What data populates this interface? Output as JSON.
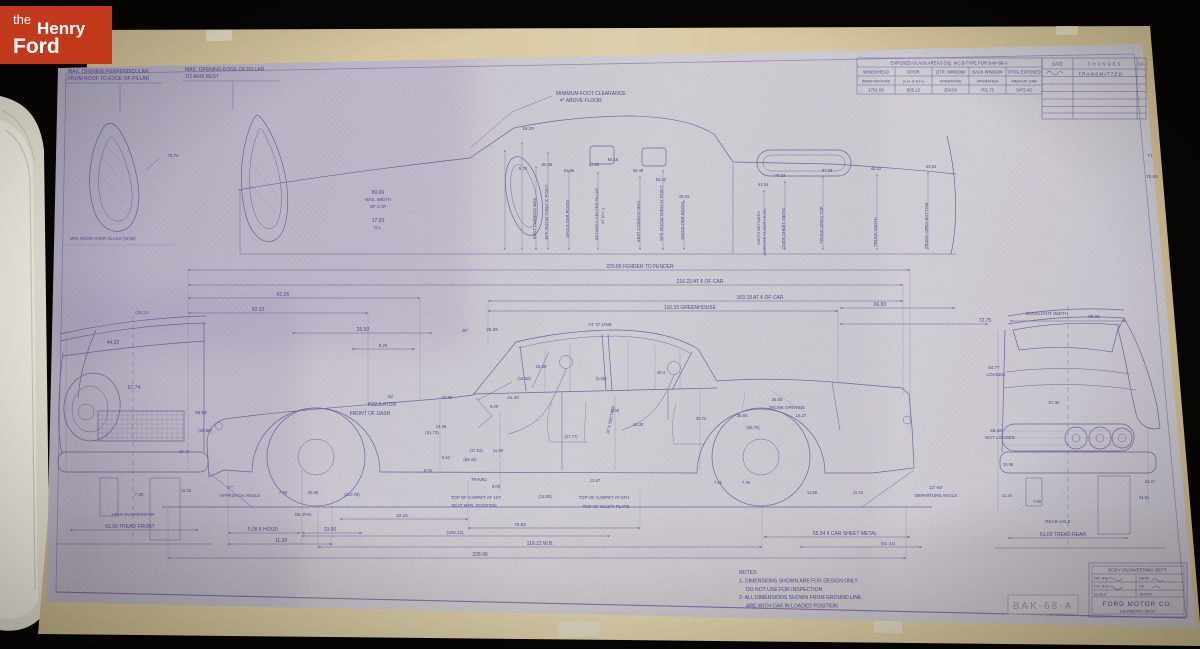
{
  "logo": {
    "prefix": "the",
    "name_top": "Henry",
    "name_bottom": "Ford"
  },
  "stamp": {
    "text": "BAK-68-A"
  },
  "colors": {
    "logo_red": "#c2391b",
    "paper": "#c8c3cd",
    "backing": "#d3c5a0",
    "ink": "#4f4890",
    "stamp_gray": "#8f8b9b"
  },
  "glass_table": {
    "title": "EXPOSED GLASS AREAS (SQ. IN.) B TYPE FOR BAK-68-A",
    "columns": [
      "WINDSHIELD",
      "DOOR",
      "QTR. WINDOW",
      "BACK WINDOW",
      "TOTAL EXPOSED"
    ],
    "sub_labels": [
      "WRAP AROUND",
      "(L.H. & R.H.)",
      "OPERATING",
      "OPERATING",
      "AREA OF CAR"
    ],
    "values": [
      "1701.03",
      "905.12",
      "254.50",
      "701.72",
      "3472.43"
    ]
  },
  "changes_table": {
    "columns": [
      "DATE",
      "CHANGES",
      "CK."
    ],
    "rows": [
      {
        "date": "",
        "change": "TRANSMITTED",
        "ck": ""
      }
    ]
  },
  "title_block": {
    "department": "BODY ENGINEERING DEPT.",
    "fields": [
      [
        "DR. BY",
        "DATE"
      ],
      [
        "CH. BY",
        "CK."
      ],
      [
        "SCALE",
        "TENTH"
      ]
    ],
    "company": "FORD MOTOR CO.",
    "location": "DEARBORN, MICH."
  },
  "notes": {
    "lines": [
      "NOTES:",
      "1- DIMENSIONS SHOWN ARE FOR DESIGN ONLY",
      "DO NOT USE FOR INSPECTION",
      "2- ALL DIMENSIONS SHOWN FROM GROUND LINE",
      "ARE WITH CAR IN LOADED POSITION"
    ]
  },
  "annotations": {
    "top_left": [
      {
        "t": "MAX. OPENING PERPENDICULAR",
        "x": 68,
        "y": 73,
        "a": "start"
      },
      {
        "t": "FROM ROOF TO EDGE OF PILLAR",
        "x": 68,
        "y": 80,
        "a": "start"
      },
      {
        "t": "MAX. OPENING EDGE OF PILLAR",
        "x": 185,
        "y": 71,
        "a": "start"
      },
      {
        "t": "TO ARM REST",
        "x": 185,
        "y": 78,
        "a": "start"
      },
      {
        "t": "78.74",
        "x": 173,
        "y": 157,
        "s": 4.4
      },
      {
        "t": "MIN. ROOM OVER GLASS (18.59)",
        "x": 70,
        "y": 240,
        "a": "start",
        "s": 4.2
      }
    ],
    "roof_section": [
      {
        "t": "MINIMUM FOOT CLEARANCE",
        "x": 556,
        "y": 95,
        "a": "start"
      },
      {
        "t": "4° ABOVE FLOOR",
        "x": 560,
        "y": 102,
        "a": "start"
      },
      {
        "t": "16.29",
        "x": 528,
        "y": 130,
        "s": 4.6
      },
      {
        "t": "80.06",
        "x": 378,
        "y": 194
      },
      {
        "t": "MAX. WIDTH",
        "x": 378,
        "y": 201,
        "s": 4.4
      },
      {
        "t": "OF CAR",
        "x": 378,
        "y": 208,
        "s": 4.4
      },
      {
        "t": "17.00",
        "x": 378,
        "y": 222
      },
      {
        "t": "O.L.",
        "x": 378,
        "y": 229,
        "s": 4.4
      },
      {
        "t": "5.75",
        "x": 523,
        "y": 170,
        "s": 4.2
      },
      {
        "t": "60.96",
        "x": 547,
        "y": 166,
        "s": 4.2
      },
      {
        "t": "61.06",
        "x": 569,
        "y": 172,
        "s": 4.2
      },
      {
        "t": "62.65",
        "x": 594,
        "y": 166,
        "s": 4.2
      },
      {
        "t": "64.16",
        "x": 613,
        "y": 161,
        "s": 4.2
      },
      {
        "t": "55.48",
        "x": 638,
        "y": 172,
        "s": 4.2
      },
      {
        "t": "53.42",
        "x": 661,
        "y": 181,
        "s": 4.2
      },
      {
        "t": "45.04",
        "x": 684,
        "y": 198,
        "s": 4.2
      },
      {
        "t": "SEAT CUSHION MAX.",
        "x": 536,
        "y": 218,
        "r": -90,
        "s": 4.2
      },
      {
        "t": "EFF. ROOM THRU 'X' POINT",
        "x": 548,
        "y": 212,
        "r": -90,
        "s": 4.2
      },
      {
        "t": "SHOULDER ROOM",
        "x": 569,
        "y": 219,
        "r": -90,
        "s": 4.2
      },
      {
        "t": "BETWEEN CENTER PILLAR",
        "x": 598,
        "y": 214,
        "r": -90,
        "s": 4
      },
      {
        "t": "AT  (D.L.)",
        "x": 604,
        "y": 216,
        "r": -90,
        "s": 4
      },
      {
        "t": "SEAT CUSHION MAX.",
        "x": 640,
        "y": 221,
        "r": -90,
        "s": 4.2
      },
      {
        "t": "EFF. ROOM THRU 'H' POINT",
        "x": 663,
        "y": 213,
        "r": -90,
        "s": 4.2
      },
      {
        "t": "SHOULDER ROOM",
        "x": 684,
        "y": 221,
        "r": -90,
        "s": 4.2
      },
      {
        "t": "41.54",
        "x": 763,
        "y": 186,
        "s": 4.2
      },
      {
        "t": "WIDTH BETWEEN",
        "x": 760,
        "y": 228,
        "r": -90,
        "s": 4
      },
      {
        "t": "W/HOUSE FLOOR LEVEL",
        "x": 766,
        "y": 232,
        "r": -90,
        "s": 4
      },
      {
        "t": "78.23",
        "x": 780,
        "y": 177,
        "s": 4.2
      },
      {
        "t": "OVER SHEET METAL",
        "x": 785,
        "y": 228,
        "r": -90,
        "s": 4.2
      },
      {
        "t": "67.28",
        "x": 827,
        "y": 172,
        "s": 4.2
      },
      {
        "t": "TRUNK OPEN TOP",
        "x": 823,
        "y": 225,
        "r": -90,
        "s": 4.2
      },
      {
        "t": "48.22",
        "x": 876,
        "y": 170,
        "s": 4.2
      },
      {
        "t": "TRUNK WIDTH",
        "x": 877,
        "y": 232,
        "r": -90,
        "s": 4.2
      },
      {
        "t": "43.54",
        "x": 931,
        "y": 168,
        "s": 4.2
      },
      {
        "t": "TRUNK OPEN BOTTOM",
        "x": 928,
        "y": 226,
        "r": -90,
        "s": 4.2
      },
      {
        "t": "75.62",
        "x": 1152,
        "y": 178,
        "s": 4.6
      },
      {
        "t": "T1",
        "x": 1150,
        "y": 157,
        "s": 4.6
      }
    ],
    "chains": [
      {
        "t": "220.86 FENDER TO FENDER",
        "x": 640,
        "y": 268
      },
      {
        "t": "216.22 AT ¢ OF CAR",
        "x": 700,
        "y": 283
      },
      {
        "t": "163.18 AT ¢ OF CAR",
        "x": 760,
        "y": 299
      },
      {
        "t": "116.33 GREENHOUSE",
        "x": 690,
        "y": 309
      },
      {
        "t": "66.93",
        "x": 880,
        "y": 306
      },
      {
        "t": "72.75",
        "x": 985,
        "y": 322
      },
      {
        "t": "61.26",
        "x": 283,
        "y": 296
      },
      {
        "t": "50.10",
        "x": 258,
        "y": 311
      },
      {
        "t": "25.50",
        "x": 363,
        "y": 331
      },
      {
        "t": "48°",
        "x": 465,
        "y": 332,
        "s": 4.6
      },
      {
        "t": "25.39",
        "x": 492,
        "y": 331,
        "s": 4.6
      },
      {
        "t": "AT 'O' LINE",
        "x": 600,
        "y": 326,
        "s": 4.6
      },
      {
        "t": "8.25",
        "x": 383,
        "y": 347,
        "s": 4.4
      }
    ],
    "side_view": [
      {
        "t": ".82",
        "x": 390,
        "y": 398,
        "s": 4.4
      },
      {
        "t": "INSULATOR",
        "x": 382,
        "y": 406
      },
      {
        "t": "FRONT OF DASH",
        "x": 370,
        "y": 415
      },
      {
        "t": "34.02",
        "x": 447,
        "y": 399,
        "s": 4.4
      },
      {
        "t": "31.40",
        "x": 513,
        "y": 399,
        "s": 4.6
      },
      {
        "t": "9.00",
        "x": 494,
        "y": 408,
        "s": 4.2
      },
      {
        "t": "25.59",
        "x": 541,
        "y": 368,
        "s": 4.4
      },
      {
        "t": "(15.62)",
        "x": 524,
        "y": 380,
        "s": 4.2
      },
      {
        "t": "(3.46)",
        "x": 601,
        "y": 380,
        "s": 4.2
      },
      {
        "t": "40.4",
        "x": 661,
        "y": 374,
        "s": 4.2
      },
      {
        "t": "AT ¢ SECTION",
        "x": 612,
        "y": 420,
        "r": -78,
        "s": 4.2
      },
      {
        "t": "24.36",
        "x": 441,
        "y": 428,
        "s": 4.2
      },
      {
        "t": "(41.73)",
        "x": 432,
        "y": 434,
        "s": 4.2
      },
      {
        "t": "(47.53)",
        "x": 476,
        "y": 452,
        "s": 4.2
      },
      {
        "t": "11.49",
        "x": 498,
        "y": 452,
        "s": 4.2
      },
      {
        "t": "(84.40)",
        "x": 470,
        "y": 461,
        "s": 4.2
      },
      {
        "t": "9.52",
        "x": 446,
        "y": 459,
        "s": 4.2
      },
      {
        "t": "6.02",
        "x": 428,
        "y": 472,
        "s": 4.2
      },
      {
        "t": "TRAVEL",
        "x": 479,
        "y": 481,
        "s": 4.2
      },
      {
        "t": "9.00",
        "x": 496,
        "y": 488,
        "s": 4.2
      },
      {
        "t": "(27.77)",
        "x": 571,
        "y": 438,
        "s": 4.2
      },
      {
        "t": "16.30",
        "x": 638,
        "y": 426,
        "s": 4.2
      },
      {
        "t": "30.73",
        "x": 701,
        "y": 420,
        "s": 4.2
      },
      {
        "t": "5.00",
        "x": 615,
        "y": 412,
        "s": 4.2
      },
      {
        "t": "12.87",
        "x": 595,
        "y": 482,
        "s": 4.2
      },
      {
        "t": "7.02",
        "x": 718,
        "y": 484,
        "s": 4.2
      },
      {
        "t": "7.46",
        "x": 746,
        "y": 484,
        "s": 4.2
      },
      {
        "t": "35.83",
        "x": 777,
        "y": 401,
        "s": 4.4
      },
      {
        "t": "TRUNK OPENING",
        "x": 787,
        "y": 409,
        "s": 4.4
      },
      {
        "t": "35.84",
        "x": 742,
        "y": 417,
        "s": 4.2
      },
      {
        "t": "16.27",
        "x": 801,
        "y": 417,
        "s": 4.4
      },
      {
        "t": "(56.70)",
        "x": 753,
        "y": 429,
        "s": 4.2
      },
      {
        "t": "TOP OF CARPET AT 1ST",
        "x": 476,
        "y": 499,
        "s": 4.4
      },
      {
        "t": "SEAT MFR. POSITION",
        "x": 474,
        "y": 507,
        "s": 4.4
      },
      {
        "t": "(13.82)",
        "x": 545,
        "y": 498,
        "s": 4.2
      },
      {
        "t": "TOP OF CARPET AT 5TH",
        "x": 604,
        "y": 499,
        "s": 4.4
      },
      {
        "t": "TOP OF SCUFF PLATE",
        "x": 606,
        "y": 508,
        "s": 4.4
      },
      {
        "t": "17°",
        "x": 230,
        "y": 489,
        "s": 4.2
      },
      {
        "t": "APPROACH ANGLE",
        "x": 240,
        "y": 497,
        "s": 4.4
      },
      {
        "t": "7.86",
        "x": 283,
        "y": 494,
        "s": 4.2
      },
      {
        "t": "25.85",
        "x": 313,
        "y": 494,
        "s": 4.2
      },
      {
        "t": "(110.78)",
        "x": 352,
        "y": 496,
        "s": 4.2
      },
      {
        "t": "OIL PAN",
        "x": 303,
        "y": 516,
        "s": 4.4
      },
      {
        "t": "5.08 ¢ HOOD",
        "x": 263,
        "y": 531
      },
      {
        "t": "23.00",
        "x": 330,
        "y": 531
      },
      {
        "t": "11.29",
        "x": 281,
        "y": 542
      },
      {
        "t": "42.15",
        "x": 402,
        "y": 517,
        "s": 4.6
      },
      {
        "t": "76.93",
        "x": 520,
        "y": 526,
        "s": 4.6
      },
      {
        "t": "(108.12)",
        "x": 455,
        "y": 534,
        "s": 4.6
      },
      {
        "t": "119.12  W.B.",
        "x": 540,
        "y": 545
      },
      {
        "t": "228.96",
        "x": 480,
        "y": 556
      },
      {
        "t": "55.34 ¢ CAR SHEET METAL",
        "x": 845,
        "y": 535
      },
      {
        "t": "(61.41)",
        "x": 888,
        "y": 545,
        "s": 4.6
      },
      {
        "t": "13°-50'",
        "x": 936,
        "y": 489,
        "s": 4.4
      },
      {
        "t": "DEPARTURE ANGLE",
        "x": 936,
        "y": 497,
        "s": 4.4
      },
      {
        "t": "11.55",
        "x": 812,
        "y": 494,
        "s": 4.2
      },
      {
        "t": "11.34",
        "x": 858,
        "y": 494,
        "s": 4.2
      }
    ],
    "front_view": [
      {
        "t": "(29.11)",
        "x": 142,
        "y": 314,
        "s": 4.4
      },
      {
        "t": "44.32",
        "x": 113,
        "y": 344
      },
      {
        "t": "67.74",
        "x": 134,
        "y": 389
      },
      {
        "t": "59.96",
        "x": 201,
        "y": 414,
        "s": 4.6
      },
      {
        "t": "(25.80)",
        "x": 205,
        "y": 432,
        "s": 4.4
      },
      {
        "t": "10.44",
        "x": 184,
        "y": 453,
        "s": 4.2
      },
      {
        "t": "7.30",
        "x": 139,
        "y": 496,
        "s": 4.6
      },
      {
        "t": "11.32",
        "x": 186,
        "y": 492,
        "s": 4.2
      },
      {
        "t": "HIGH SUSPENSION",
        "x": 133,
        "y": 516,
        "s": 4.6
      },
      {
        "t": "61.00 TREAD FRONT",
        "x": 130,
        "y": 528
      }
    ],
    "rear_view": [
      {
        "t": "BACKLIGHT WIDTH",
        "x": 1047,
        "y": 315,
        "s": 4.6
      },
      {
        "t": "65.26",
        "x": 1094,
        "y": 318,
        "s": 4.6
      },
      {
        "t": "54.77",
        "x": 994,
        "y": 369,
        "s": 4.6
      },
      {
        "t": "LOADED",
        "x": 996,
        "y": 376,
        "s": 4.6
      },
      {
        "t": "57.36",
        "x": 1054,
        "y": 404,
        "s": 4.4
      },
      {
        "t": "56.36",
        "x": 996,
        "y": 432,
        "s": 4.6
      },
      {
        "t": "NOT LOADED",
        "x": 1000,
        "y": 439,
        "s": 4.6
      },
      {
        "t": "10.06",
        "x": 1008,
        "y": 466,
        "s": 4.2
      },
      {
        "t": "11.34",
        "x": 1007,
        "y": 497,
        "s": 4.2
      },
      {
        "t": "7.80",
        "x": 1037,
        "y": 503,
        "s": 4.2
      },
      {
        "t": "24.27",
        "x": 1150,
        "y": 483,
        "s": 4.2
      },
      {
        "t": "24.51",
        "x": 1144,
        "y": 499,
        "s": 4.2
      },
      {
        "t": "REAR AXLE",
        "x": 1058,
        "y": 523,
        "s": 4.6
      },
      {
        "t": "61.00 TREAD REAR",
        "x": 1063,
        "y": 536
      }
    ]
  }
}
